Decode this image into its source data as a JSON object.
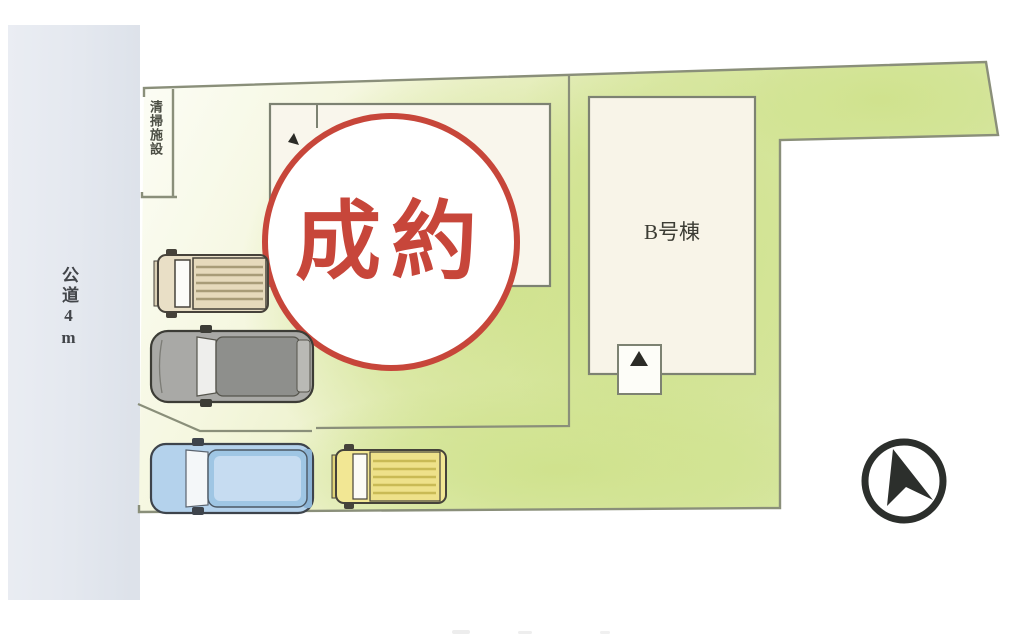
{
  "page": {
    "background": "#ffffff"
  },
  "road": {
    "label": "公道4m",
    "fill": "#e6eaf1",
    "text_color": "#42454a"
  },
  "refuse_area": {
    "label": "清掃施設"
  },
  "plot": {
    "fill_light": "#fcfdf6",
    "fill_green": "#d6e6a0",
    "outline_color": "#8a8f7a"
  },
  "building_a": {
    "fill": "#f9f6ec"
  },
  "building_b": {
    "label": "B号棟",
    "fill": "#f8f4e8",
    "marker_color": "#2b2b26"
  },
  "stamp": {
    "label": "成約",
    "color": "#c7463a"
  },
  "vehicles": [
    {
      "name": "cargo-van-beige",
      "body_color": "#e9dfc6",
      "stripe_color": "#a89c78"
    },
    {
      "name": "sedan-gray",
      "body_color": "#a9a9a6",
      "roof_color": "#8e8f8c"
    },
    {
      "name": "minivan-blue",
      "body_color": "#b4d2ec",
      "roof_color": "#9fc6e4"
    },
    {
      "name": "cargo-van-yellow",
      "body_color": "#f2e794",
      "stripe_color": "#c9ba55"
    }
  ],
  "compass": {
    "color": "#2c2f2c"
  }
}
